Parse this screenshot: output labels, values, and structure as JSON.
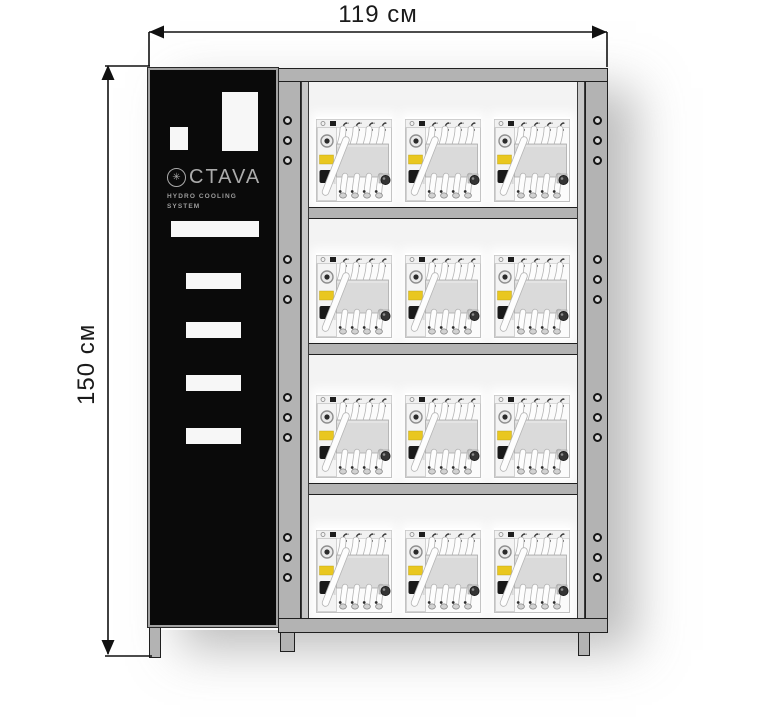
{
  "dimension_labels": {
    "width": "119 см",
    "height": "150 см"
  },
  "brand_panel": {
    "logo_icon": "snowflake-gear",
    "logo_icon_glyph": "✳",
    "logo_text": "CTAVA",
    "subtitle_line1": "HYDRO COOLING",
    "subtitle_line2": "SYSTEM",
    "panel_color": "#0a0a0a",
    "logo_color": "#ababab",
    "cutout_color": "#f7f7f7"
  },
  "rack": {
    "rows": 4,
    "units_per_row": 3,
    "total_units": 12,
    "screw_holes_per_rail_section": 3,
    "frame_color": "#b3b3b3",
    "interior_color": "#f3f3f3",
    "outline_color": "#1f1f1f"
  },
  "miner_unit": {
    "name": "water-cooled-asic-unit",
    "body_color": "#fbfbfb",
    "center_block_color": "#dadada",
    "hose_color": "#fdfdfd",
    "sticker_color": "#e9c71f",
    "top_hoses": 4,
    "bottom_hoses": 4
  }
}
